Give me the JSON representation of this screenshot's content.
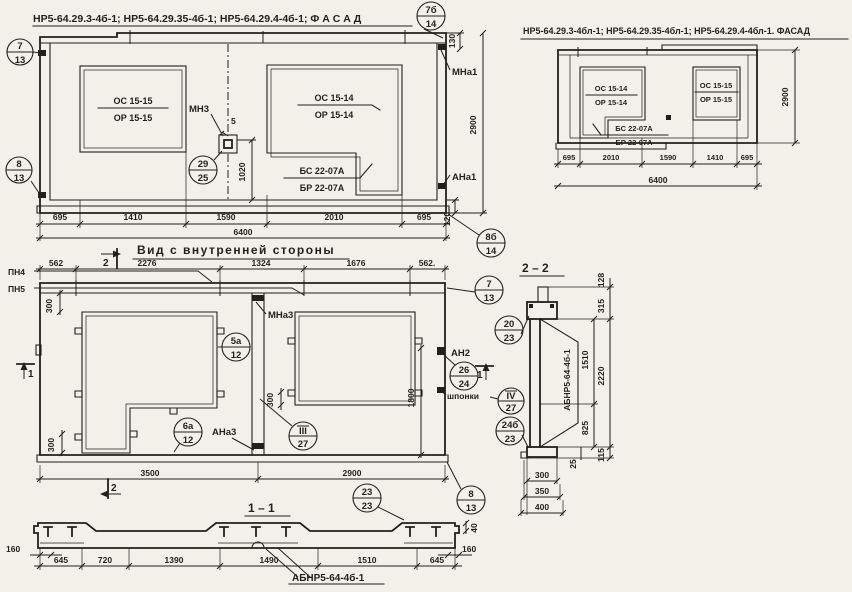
{
  "colors": {
    "paper": "#f3f0ea",
    "ink": "#221f1c"
  },
  "facade_main": {
    "title": "НР5-64.29.3-4б-1; НР5-64.29.35-4б-1; НР5-64.29.4-4б-1;  Ф А С А Д",
    "window1": {
      "top": "ОС 15-15",
      "bottom": "ОР 15-15"
    },
    "window2": {
      "top": "ОС 15-14",
      "bottom": "ОР 15-14"
    },
    "window2b": {
      "top": "БС 22-07А",
      "bottom": "БР 22-07А"
    },
    "labels": {
      "mn3": "МН3",
      "mna1": "МНа1",
      "ana1": "АНа1"
    },
    "dims": {
      "d5": "5",
      "d1020": "1020",
      "d130": "130",
      "d2900": "2900",
      "d120": "120",
      "bottom": [
        "695",
        "1410",
        "1590",
        "2010",
        "695"
      ],
      "total": "6400"
    },
    "callouts": {
      "c7b14": {
        "top": "7б",
        "bottom": "14"
      },
      "c713": {
        "top": "7",
        "bottom": "13"
      },
      "c813": {
        "top": "8",
        "bottom": "13"
      },
      "c2925": {
        "top": "29",
        "bottom": "25"
      },
      "c8b14": {
        "top": "8б",
        "bottom": "14"
      }
    }
  },
  "facade_mirror": {
    "title": "НР5-64.29.3-4бл-1; НР5-64.29.35-4бл-1; НР5-64.29.4-4бл-1. ФАСАД",
    "window1": {
      "top": "ОС 15-14",
      "bottom": "ОР 15-14"
    },
    "window1b": {
      "top": "БС 22-07А",
      "bottom": "БР 22-07А"
    },
    "window2": {
      "top": "ОС 15-15",
      "bottom": "ОР 15-15"
    },
    "dims": {
      "bottom": [
        "695",
        "2010",
        "1590",
        "1410",
        "695"
      ],
      "total": "6400",
      "d2900": "2900"
    }
  },
  "inner_view": {
    "title": "Вид с внутренней стороны",
    "labels": {
      "pn4": "ПН4",
      "pn5": "ПН5",
      "mna3": "МНа3",
      "an2": "АН2",
      "ana3": "АНа3",
      "shponki": "шпонки"
    },
    "dims": {
      "top": [
        "562",
        "2276",
        "1324",
        "1676",
        "562."
      ],
      "d300a": "300",
      "d300b": "300",
      "d300c": "300",
      "d1800": "1800",
      "d3500": "3500",
      "d2900": "2900"
    },
    "sections": {
      "s1": "1",
      "s2": "2"
    },
    "callouts": {
      "c713": {
        "top": "7",
        "bottom": "13"
      },
      "c5a12": {
        "top": "5а",
        "bottom": "12"
      },
      "c6a12": {
        "top": "6а",
        "bottom": "12"
      },
      "c2624": {
        "top": "26",
        "bottom": "24"
      },
      "c427": {
        "top": "IV",
        "bottom": "27"
      },
      "c327": {
        "top": "III",
        "bottom": "27"
      },
      "c2323": {
        "top": "23",
        "bottom": "23"
      },
      "c813": {
        "top": "8",
        "bottom": "13"
      }
    }
  },
  "section22": {
    "title": "2 – 2",
    "label_abnr": "АБНР5-64-4б-1",
    "dims": {
      "d128": "128",
      "d315": "315",
      "d1510": "1510",
      "d2220": "2220",
      "d825": "825",
      "d25": "25",
      "d115": "115",
      "d300": "300",
      "d350": "350",
      "d400": "400"
    },
    "callouts": {
      "c2023": {
        "top": "20",
        "bottom": "23"
      },
      "c24b23": {
        "top": "24б",
        "bottom": "23"
      }
    }
  },
  "section11": {
    "title": "1 – 1",
    "label_abnr": "АБНР5-64-4б-1",
    "dims": {
      "bottom": [
        "645",
        "720",
        "1390",
        "1490",
        "1510",
        "645"
      ],
      "d160l": "160",
      "d160r": "160",
      "d40": "40"
    }
  }
}
